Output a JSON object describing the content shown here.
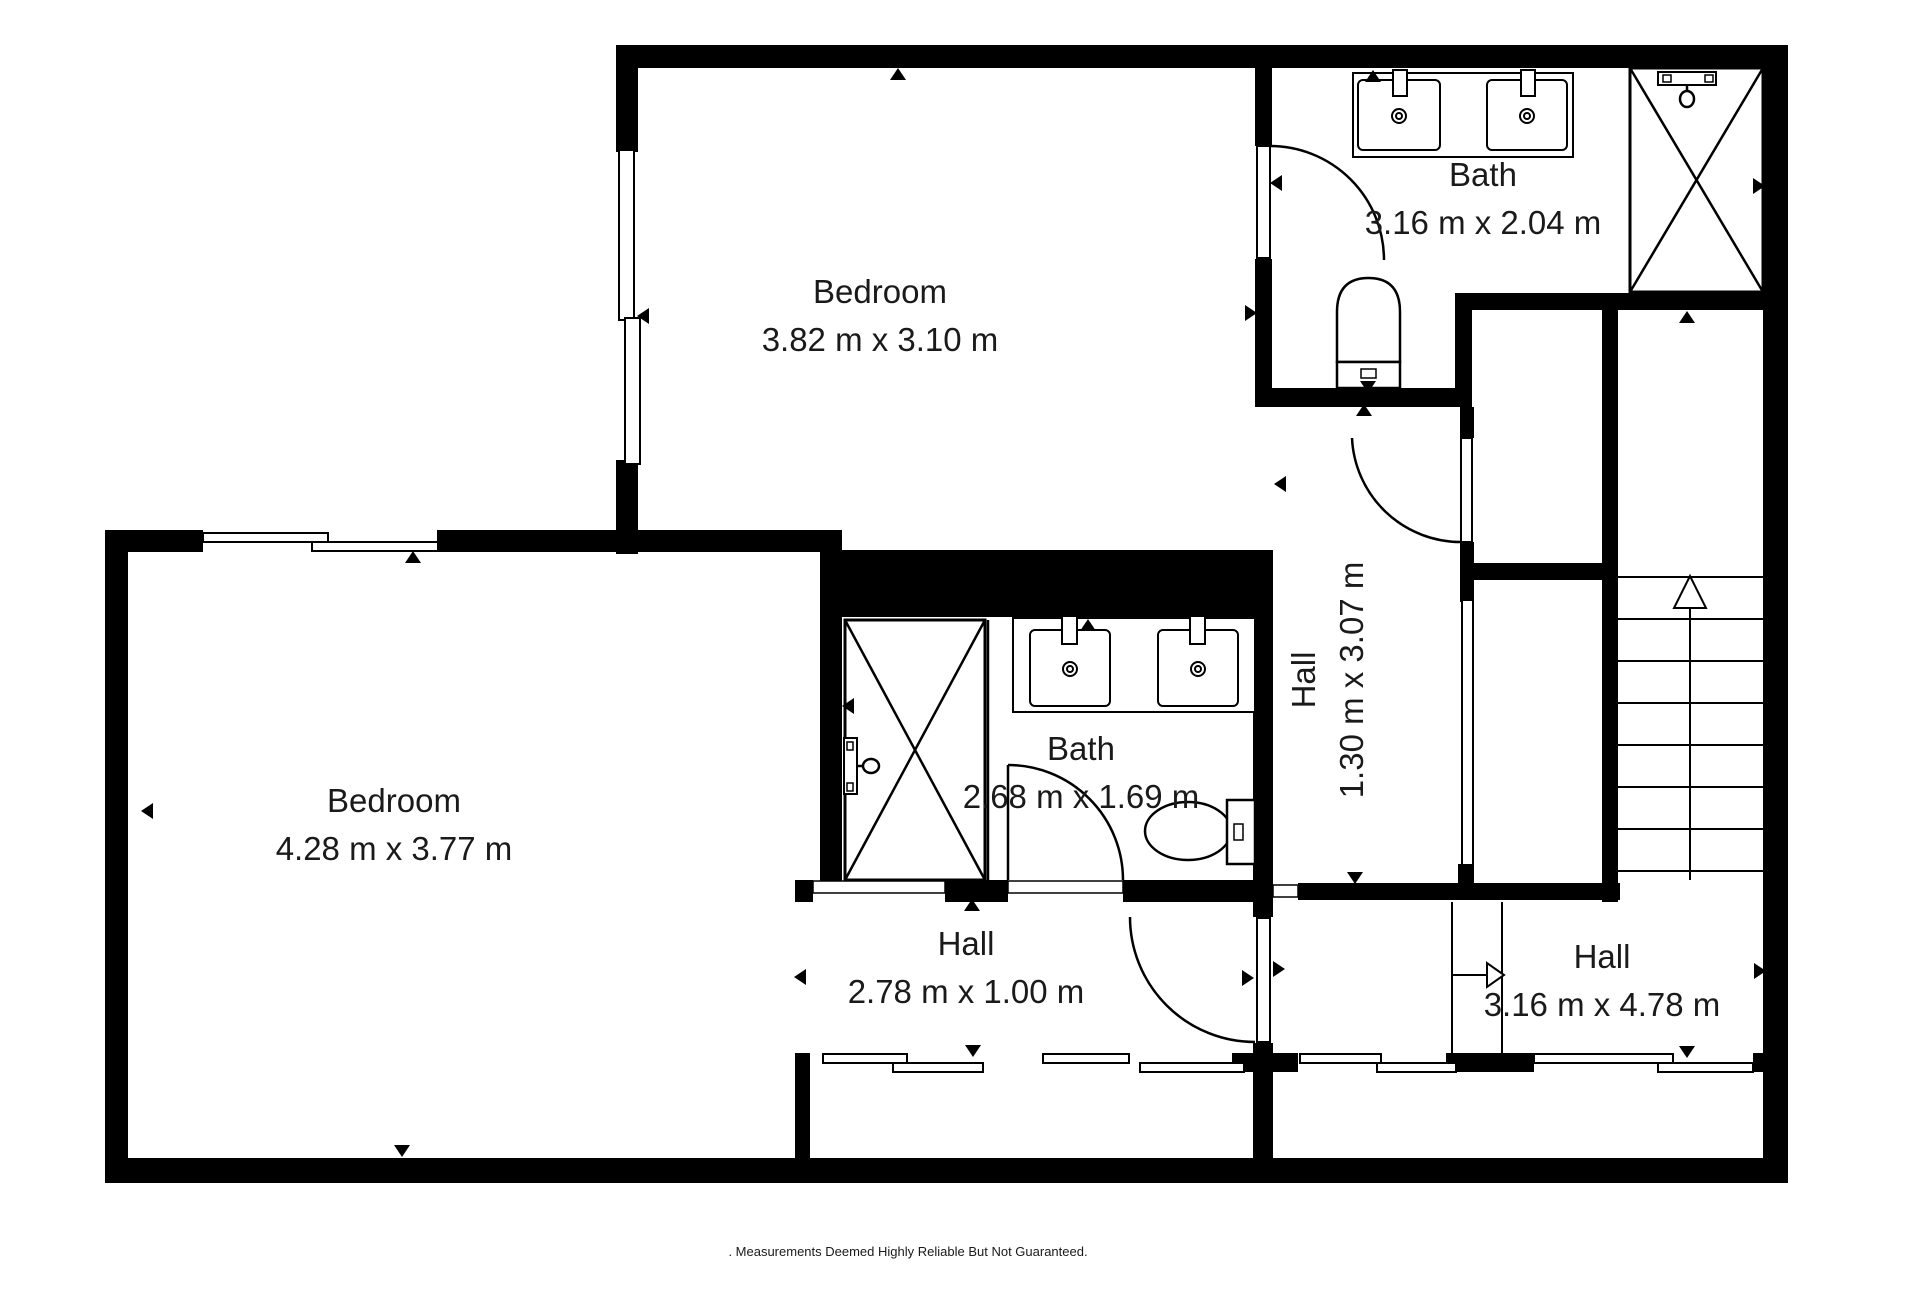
{
  "title": "floor-plan",
  "footer": ". Measurements Deemed Highly Reliable But Not Guaranteed.",
  "colors": {
    "wall": "#000000",
    "bg": "#ffffff",
    "text": "#1a1a1a"
  },
  "rooms": [
    {
      "id": "bedroom-top",
      "name": "Bedroom",
      "dims": "3.82 m x 3.10 m",
      "cx": 880,
      "name_y": 303,
      "dims_y": 351,
      "rotated": false
    },
    {
      "id": "bath-top",
      "name": "Bath",
      "dims": "3.16 m x 2.04 m",
      "cx": 1483,
      "name_y": 186,
      "dims_y": 234,
      "rotated": false
    },
    {
      "id": "bedroom-bottom",
      "name": "Bedroom",
      "dims": "4.28 m x 3.77 m",
      "cx": 394,
      "name_y": 812,
      "dims_y": 860,
      "rotated": false
    },
    {
      "id": "bath-middle",
      "name": "Bath",
      "dims": "2.68 m x 1.69 m",
      "cx": 1081,
      "name_y": 760,
      "dims_y": 808,
      "rotated": false
    },
    {
      "id": "hall-vertical",
      "name": "Hall",
      "dims": "1.30 m x 3.07 m",
      "cx": 1335,
      "cy": 680,
      "dy1": -20,
      "dy2": 28,
      "rotated": true
    },
    {
      "id": "hall-middle",
      "name": "Hall",
      "dims": "2.78 m x 1.00 m",
      "cx": 966,
      "name_y": 955,
      "dims_y": 1003,
      "rotated": false
    },
    {
      "id": "hall-right",
      "name": "Hall",
      "dims": "3.16 m x 4.78 m",
      "cx": 1602,
      "name_y": 968,
      "dims_y": 1016,
      "rotated": false
    }
  ],
  "walls": [
    {
      "n": "wall-exterior-top",
      "r": [
        616,
        45,
        1172,
        23
      ]
    },
    {
      "n": "wall-exterior-right",
      "r": [
        1763,
        45,
        25,
        1138
      ]
    },
    {
      "n": "wall-exterior-bottom",
      "r": [
        105,
        1158,
        1683,
        25
      ]
    },
    {
      "n": "wall-exterior-left",
      "r": [
        105,
        530,
        23,
        650
      ]
    },
    {
      "n": "wall-bedroomtop-left-upper",
      "r": [
        616,
        45,
        22,
        107
      ]
    },
    {
      "n": "wall-bedroomtop-left-lower",
      "r": [
        616,
        460,
        22,
        94
      ]
    },
    {
      "n": "wall-bedroombottom-top-left",
      "r": [
        105,
        530,
        98,
        22
      ]
    },
    {
      "n": "wall-bedroombottom-top-right",
      "r": [
        437,
        530,
        405,
        22
      ]
    },
    {
      "n": "wall-bath-middle-top-thick",
      "r": [
        820,
        550,
        453,
        67
      ]
    },
    {
      "n": "wall-bedroom-bath-divider",
      "r": [
        820,
        552,
        22,
        330
      ]
    },
    {
      "n": "wall-hall-middle-stub",
      "r": [
        795,
        880,
        18,
        22
      ]
    },
    {
      "n": "wall-bath-middle-bottom-left",
      "r": [
        945,
        880,
        63,
        22
      ]
    },
    {
      "n": "wall-bath-middle-bottom-right",
      "r": [
        1123,
        880,
        130,
        22
      ]
    },
    {
      "n": "wall-hall-vertical-left",
      "r": [
        1253,
        617,
        20,
        300
      ]
    },
    {
      "n": "wall-halls-door-lower",
      "r": [
        1253,
        1043,
        20,
        29
      ]
    },
    {
      "n": "wall-lower-divider",
      "r": [
        1253,
        1072,
        20,
        90
      ]
    },
    {
      "n": "wall-lower-left",
      "r": [
        795,
        1053,
        15,
        109
      ]
    },
    {
      "n": "wall-bathtop-left-upper",
      "r": [
        1255,
        68,
        17,
        78
      ]
    },
    {
      "n": "wall-bathtop-left-lower",
      "r": [
        1255,
        259,
        17,
        148
      ]
    },
    {
      "n": "wall-bathtop-bottom",
      "r": [
        1255,
        388,
        205,
        19
      ]
    },
    {
      "n": "wall-below-shower",
      "r": [
        1460,
        293,
        303,
        17
      ]
    },
    {
      "n": "wall-connector",
      "r": [
        1455,
        293,
        17,
        114
      ]
    },
    {
      "n": "wall-closet-left-upper",
      "r": [
        1460,
        407,
        14,
        31
      ]
    },
    {
      "n": "wall-closet-left-lower",
      "r": [
        1460,
        542,
        14,
        60
      ]
    },
    {
      "n": "wall-closet-bottom",
      "r": [
        1460,
        563,
        142,
        17
      ]
    },
    {
      "n": "wall-closet-stairs-divider",
      "r": [
        1602,
        310,
        16,
        592
      ]
    },
    {
      "n": "wall-hallright-top",
      "r": [
        1298,
        883,
        322,
        17
      ]
    },
    {
      "n": "wall-stub-above-band",
      "r": [
        1458,
        864,
        16,
        20
      ]
    },
    {
      "n": "wall-band-block-mid",
      "r": [
        1232,
        1053,
        66,
        19
      ]
    },
    {
      "n": "wall-band-block-stair",
      "r": [
        1446,
        1053,
        88,
        19
      ]
    },
    {
      "n": "wall-band-block-right",
      "r": [
        1753,
        1053,
        12,
        19
      ]
    }
  ],
  "windows": [
    {
      "n": "window-bedroomtop-left-1",
      "r": [
        619,
        150,
        15,
        170
      ]
    },
    {
      "n": "window-bedroomtop-left-2",
      "r": [
        625,
        318,
        15,
        146
      ]
    },
    {
      "n": "window-bedroombottom-1",
      "r": [
        203,
        533,
        125,
        9
      ]
    },
    {
      "n": "window-bedroombottom-2",
      "r": [
        312,
        542,
        126,
        9
      ]
    },
    {
      "n": "window-band-1",
      "r": [
        823,
        1054,
        84,
        9
      ]
    },
    {
      "n": "window-band-2",
      "r": [
        893,
        1063,
        90,
        9
      ]
    },
    {
      "n": "window-band-3",
      "r": [
        1043,
        1054,
        86,
        9
      ]
    },
    {
      "n": "window-band-4",
      "r": [
        1140,
        1063,
        104,
        9
      ]
    },
    {
      "n": "window-band-5",
      "r": [
        1300,
        1054,
        81,
        9
      ]
    },
    {
      "n": "window-band-6",
      "r": [
        1377,
        1063,
        79,
        9
      ]
    },
    {
      "n": "window-band-7",
      "r": [
        1534,
        1054,
        139,
        9
      ]
    },
    {
      "n": "window-band-8",
      "r": [
        1658,
        1063,
        95,
        9
      ]
    },
    {
      "n": "window-hall-glass",
      "r": [
        1462,
        600,
        11,
        265
      ]
    }
  ],
  "thresholds": [
    {
      "n": "opening-bedroom-hall",
      "r": [
        813,
        881,
        132,
        12
      ]
    },
    {
      "n": "opening-bath-middle-door",
      "r": [
        1008,
        881,
        115,
        12
      ]
    },
    {
      "n": "opening-hall-corner",
      "r": [
        1273,
        885,
        25,
        12
      ]
    }
  ],
  "doors": [
    {
      "n": "door-bath-top",
      "leaf": [
        1257,
        146,
        13,
        112
      ],
      "arc": "M 1270 146 A 114 114 0 0 1 1384 260"
    },
    {
      "n": "door-closet",
      "leaf": [
        1461,
        438,
        11,
        104
      ],
      "arc": "M 1352 438 A 109 109 0 0 0 1461 542"
    },
    {
      "n": "door-bath-middle",
      "line": [
        1008,
        880,
        1008,
        765
      ],
      "arc": "M 1008 765 A 115 115 0 0 1 1123 880"
    },
    {
      "n": "door-halls",
      "leaf": [
        1257,
        918,
        13,
        124
      ],
      "arc": "M 1130 917 A 125 125 0 0 0 1255 1042"
    }
  ],
  "stairs": {
    "treads_x1": 1618,
    "treads_x2": 1763,
    "treads_y": [
      577,
      619,
      661,
      703,
      745,
      787,
      829,
      871
    ],
    "centerline": [
      1690,
      600,
      1690,
      880
    ],
    "up_arrow": "1690,576 1674,608 1706,608",
    "strip_lines": [
      [
        1452,
        902,
        1452,
        1053
      ],
      [
        1502,
        902,
        1502,
        1053
      ],
      [
        1452,
        975,
        1487,
        975
      ]
    ],
    "strip_arrow": "1504,975 1487,963 1487,987"
  },
  "fixtures": [
    {
      "n": "shower-top-right",
      "p": [
        {
          "t": "rect",
          "r": [
            1630,
            68,
            133,
            224
          ],
          "sw": 3
        },
        {
          "t": "line",
          "l": [
            1630,
            68,
            1763,
            292
          ]
        },
        {
          "t": "line",
          "l": [
            1763,
            68,
            1630,
            292
          ]
        },
        {
          "t": "rect",
          "r": [
            1658,
            72,
            58,
            13
          ],
          "sw": 2
        },
        {
          "t": "rect",
          "r": [
            1663,
            75,
            8,
            7
          ],
          "sw": 1.5
        },
        {
          "t": "rect",
          "r": [
            1705,
            75,
            8,
            7
          ],
          "sw": 1.5
        },
        {
          "t": "line",
          "l": [
            1687,
            85,
            1687,
            92
          ]
        },
        {
          "t": "ellipse",
          "e": [
            1687,
            99,
            7,
            8
          ]
        }
      ]
    },
    {
      "n": "shower-middle",
      "p": [
        {
          "t": "rect",
          "r": [
            845,
            620,
            140,
            260
          ],
          "sw": 3
        },
        {
          "t": "line",
          "l": [
            845,
            620,
            985,
            880
          ]
        },
        {
          "t": "line",
          "l": [
            985,
            620,
            845,
            880
          ]
        },
        {
          "t": "line",
          "l": [
            988,
            620,
            988,
            880
          ]
        },
        {
          "t": "rect",
          "r": [
            844,
            738,
            13,
            56
          ],
          "sw": 2
        },
        {
          "t": "rect",
          "r": [
            847,
            742,
            6,
            8
          ],
          "sw": 1.5
        },
        {
          "t": "rect",
          "r": [
            847,
            783,
            6,
            8
          ],
          "sw": 1.5
        },
        {
          "t": "line",
          "l": [
            857,
            766,
            863,
            766
          ]
        },
        {
          "t": "ellipse",
          "e": [
            871,
            766,
            8,
            7
          ]
        }
      ]
    },
    {
      "n": "vanity-top",
      "p": [
        {
          "t": "rect",
          "r": [
            1353,
            73,
            220,
            84
          ],
          "sw": 2
        },
        {
          "t": "rect",
          "r": [
            1358,
            80,
            82,
            70
          ],
          "sw": 2,
          "rx": 5
        },
        {
          "t": "rect",
          "r": [
            1487,
            80,
            80,
            70
          ],
          "sw": 2,
          "rx": 5
        },
        {
          "t": "rect",
          "r": [
            1393,
            70,
            14,
            26
          ],
          "sw": 2
        },
        {
          "t": "rect",
          "r": [
            1521,
            70,
            14,
            26
          ],
          "sw": 2
        },
        {
          "t": "circle",
          "c": [
            1399,
            116,
            7
          ]
        },
        {
          "t": "circle",
          "c": [
            1399,
            116,
            3
          ]
        },
        {
          "t": "circle",
          "c": [
            1527,
            116,
            7
          ]
        },
        {
          "t": "circle",
          "c": [
            1527,
            116,
            3
          ]
        }
      ]
    },
    {
      "n": "vanity-middle",
      "p": [
        {
          "t": "rect",
          "r": [
            1013,
            618,
            242,
            94
          ],
          "sw": 2
        },
        {
          "t": "rect",
          "r": [
            1030,
            630,
            80,
            76
          ],
          "sw": 2,
          "rx": 5
        },
        {
          "t": "rect",
          "r": [
            1158,
            630,
            80,
            76
          ],
          "sw": 2,
          "rx": 5
        },
        {
          "t": "rect",
          "r": [
            1062,
            616,
            15,
            28
          ],
          "sw": 2
        },
        {
          "t": "rect",
          "r": [
            1190,
            616,
            15,
            28
          ],
          "sw": 2
        },
        {
          "t": "circle",
          "c": [
            1070,
            669,
            7
          ]
        },
        {
          "t": "circle",
          "c": [
            1070,
            669,
            3
          ]
        },
        {
          "t": "circle",
          "c": [
            1198,
            669,
            7
          ]
        },
        {
          "t": "circle",
          "c": [
            1198,
            669,
            3
          ]
        }
      ]
    },
    {
      "n": "toilet-top",
      "p": [
        {
          "t": "path",
          "d": "M 1337 362 L 1337 312 Q 1337 278 1368.5 278 Q 1400 278 1400 312 L 1400 362 Z",
          "sw": 2.5
        },
        {
          "t": "rect",
          "r": [
            1337,
            362,
            63,
            26
          ],
          "sw": 2.5
        },
        {
          "t": "rect",
          "r": [
            1361,
            369,
            15,
            9
          ],
          "sw": 1.5
        }
      ]
    },
    {
      "n": "toilet-middle",
      "p": [
        {
          "t": "ellipse",
          "e": [
            1188,
            831,
            43,
            29
          ],
          "sw": 2.5
        },
        {
          "t": "rect",
          "r": [
            1227,
            800,
            28,
            64
          ],
          "sw": 2.5
        },
        {
          "t": "rect",
          "r": [
            1234,
            824,
            9,
            16
          ],
          "sw": 1.5
        }
      ]
    }
  ],
  "markers": [
    {
      "x": 898,
      "y": 74,
      "dir": "up"
    },
    {
      "x": 1373,
      "y": 76,
      "dir": "up"
    },
    {
      "x": 643,
      "y": 316,
      "dir": "left"
    },
    {
      "x": 1251,
      "y": 313,
      "dir": "right"
    },
    {
      "x": 1276,
      "y": 183,
      "dir": "left"
    },
    {
      "x": 1759,
      "y": 186,
      "dir": "right"
    },
    {
      "x": 1687,
      "y": 317,
      "dir": "up"
    },
    {
      "x": 1368,
      "y": 387,
      "dir": "down"
    },
    {
      "x": 1364,
      "y": 410,
      "dir": "up"
    },
    {
      "x": 1088,
      "y": 625,
      "dir": "up"
    },
    {
      "x": 1280,
      "y": 484,
      "dir": "left"
    },
    {
      "x": 848,
      "y": 706,
      "dir": "left"
    },
    {
      "x": 147,
      "y": 811,
      "dir": "left"
    },
    {
      "x": 413,
      "y": 557,
      "dir": "up"
    },
    {
      "x": 402,
      "y": 1151,
      "dir": "down"
    },
    {
      "x": 972,
      "y": 905,
      "dir": "up"
    },
    {
      "x": 800,
      "y": 977,
      "dir": "left"
    },
    {
      "x": 973,
      "y": 1051,
      "dir": "down"
    },
    {
      "x": 1248,
      "y": 978,
      "dir": "right"
    },
    {
      "x": 1279,
      "y": 969,
      "dir": "right"
    },
    {
      "x": 1355,
      "y": 878,
      "dir": "down"
    },
    {
      "x": 1687,
      "y": 1052,
      "dir": "down"
    },
    {
      "x": 1760,
      "y": 971,
      "dir": "right"
    }
  ]
}
